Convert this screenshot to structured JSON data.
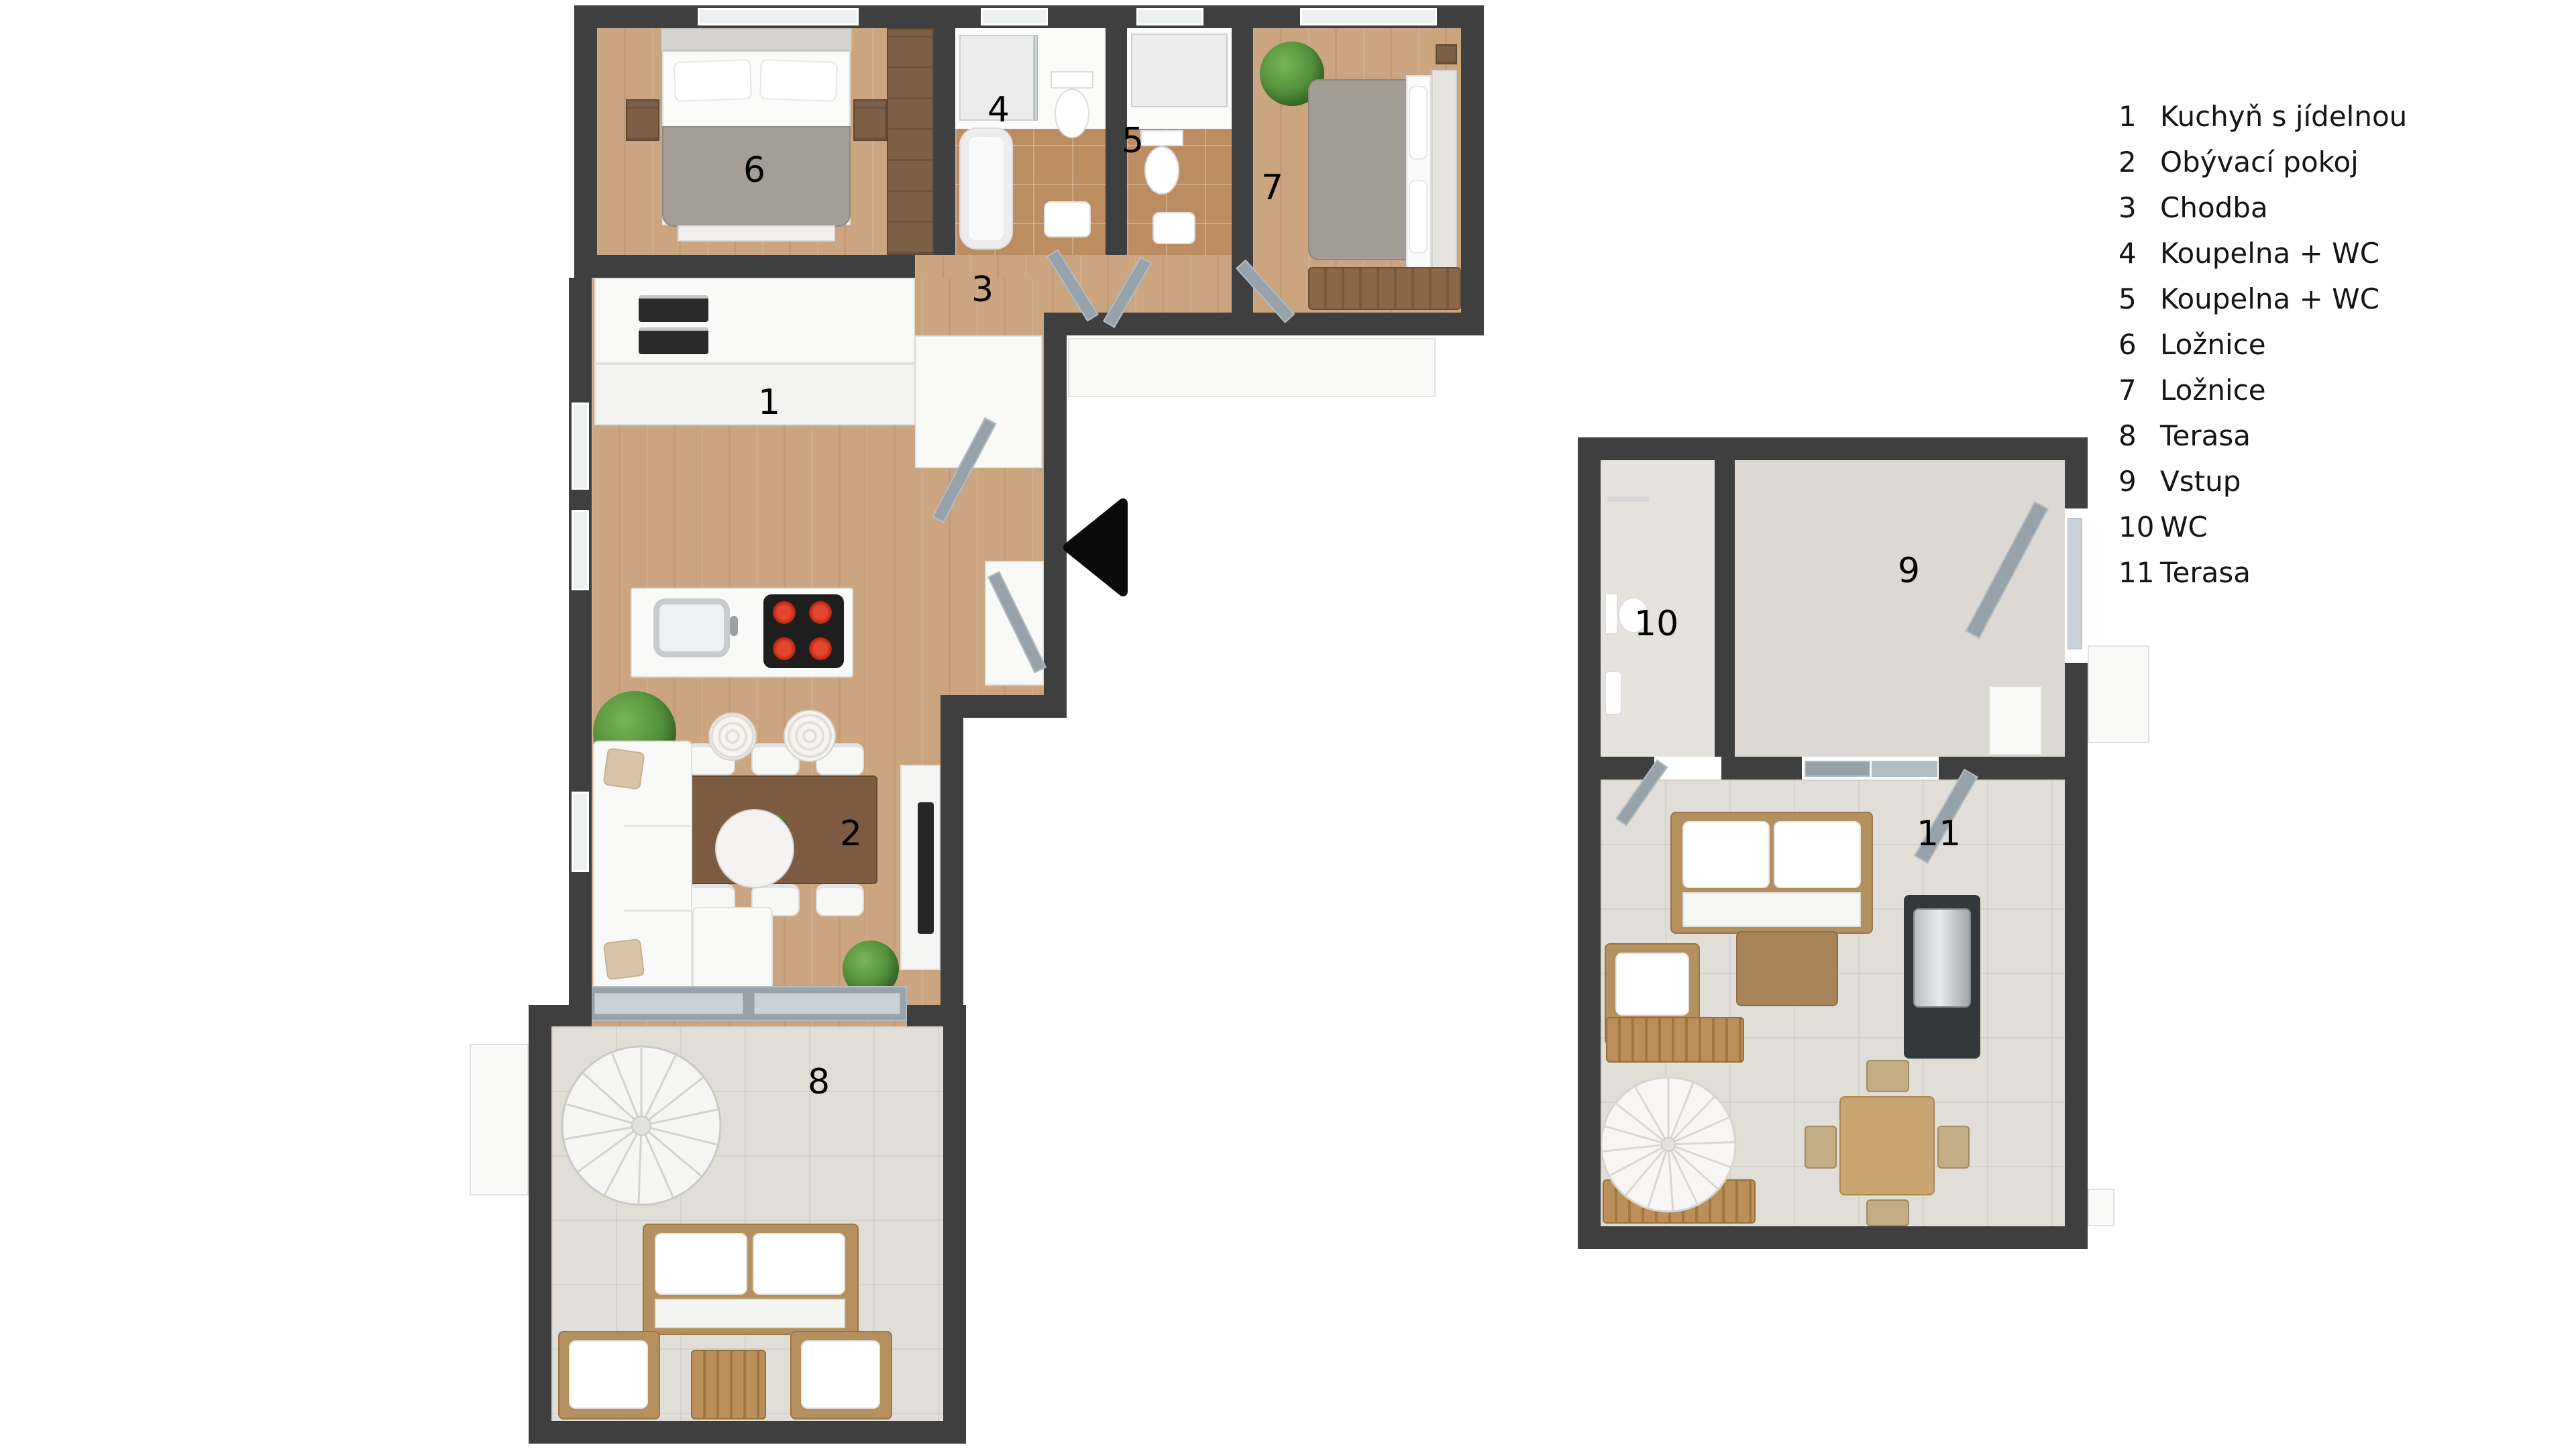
{
  "legend": {
    "items": [
      {
        "number": "1",
        "label": "Kuchyň s jídelnou"
      },
      {
        "number": "2",
        "label": "Obývací pokoj"
      },
      {
        "number": "3",
        "label": "Chodba"
      },
      {
        "number": "4",
        "label": "Koupelna + WC"
      },
      {
        "number": "5",
        "label": "Koupelna + WC"
      },
      {
        "number": "6",
        "label": "Ložnice"
      },
      {
        "number": "7",
        "label": "Ložnice"
      },
      {
        "number": "8",
        "label": "Terasa"
      },
      {
        "number": "9",
        "label": "Vstup"
      },
      {
        "number": "10",
        "label": "WC"
      },
      {
        "number": "11",
        "label": "Terasa"
      }
    ]
  },
  "icons": {
    "direction_arrow": "left-triangle-arrow",
    "spiral_staircase": "spiral-stairs",
    "parasol": "radial-parasol"
  },
  "colors": {
    "wall": "#3f3f3f",
    "wood_floor": "#cba57f",
    "bathroom_tile": "#bd8d62",
    "outdoor_tile": "#e1ded8",
    "door": "#97a2ab",
    "cooktop_burner": "#d63420",
    "arrow": "#0b0b0b"
  }
}
